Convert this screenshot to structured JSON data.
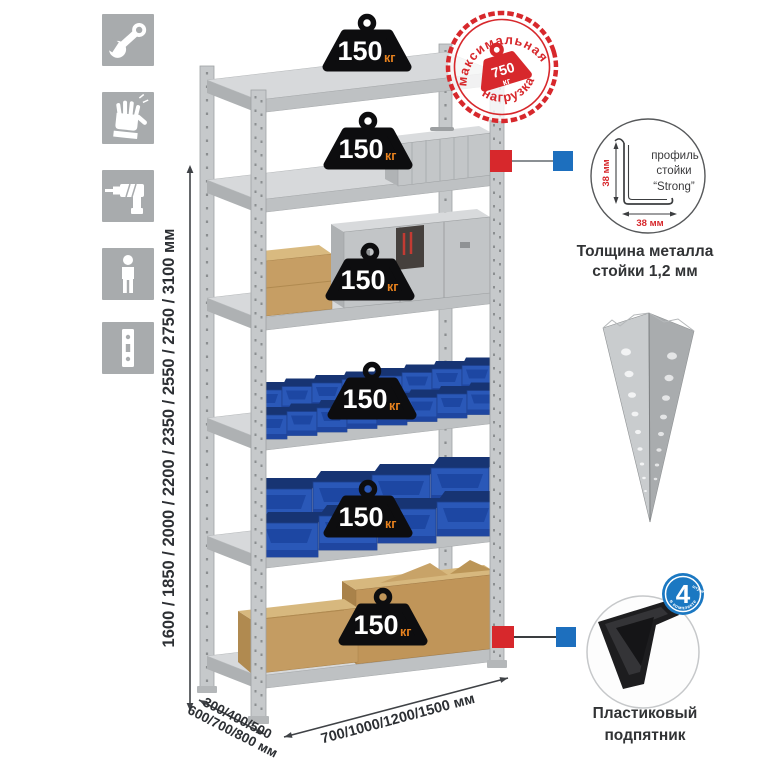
{
  "page": {
    "background": "#ffffff"
  },
  "colors": {
    "accent_red": "#d7282c",
    "accent_blue": "#1d6fbe",
    "bin_blue": "#2a58b8",
    "metal_gray": "#c6c9cb",
    "weight_black": "#0d0d0f",
    "unit_orange": "#e8821e",
    "icon_gray": "#a8abad"
  },
  "left_icons": [
    {
      "name": "wrench"
    },
    {
      "name": "gloves"
    },
    {
      "name": "drill"
    },
    {
      "name": "person"
    },
    {
      "name": "perforated-post"
    }
  ],
  "dimensions": {
    "height": "1600 / 1850 / 2000 / 2200 / 2350 / 2550 / 2750 / 3100 мм",
    "depth_line1": "300/400/500",
    "depth_line2": "600/700/800 мм",
    "width": "700/1000/1200/1500 мм"
  },
  "shelves": [
    {
      "value": "150",
      "unit": "кг"
    },
    {
      "value": "150",
      "unit": "кг"
    },
    {
      "value": "150",
      "unit": "кг"
    },
    {
      "value": "150",
      "unit": "кг"
    },
    {
      "value": "150",
      "unit": "кг"
    },
    {
      "value": "150",
      "unit": "кг"
    }
  ],
  "stamp": {
    "arc_top": "максимальная",
    "arc_bottom": "нагрузка",
    "value": "750",
    "unit": "кг"
  },
  "profile_detail": {
    "line1": "профиль",
    "line2": "стойки",
    "line3": "“Strong”",
    "dim_v": "38 мм",
    "dim_h": "38 мм",
    "caption1": "Толщина металла",
    "caption2": "стойки 1,2 мм"
  },
  "foot_detail": {
    "badge_value": "4",
    "badge_small": "штуки",
    "badge_arc": "в комплекте",
    "caption1": "Пластиковый",
    "caption2": "подпятник"
  }
}
